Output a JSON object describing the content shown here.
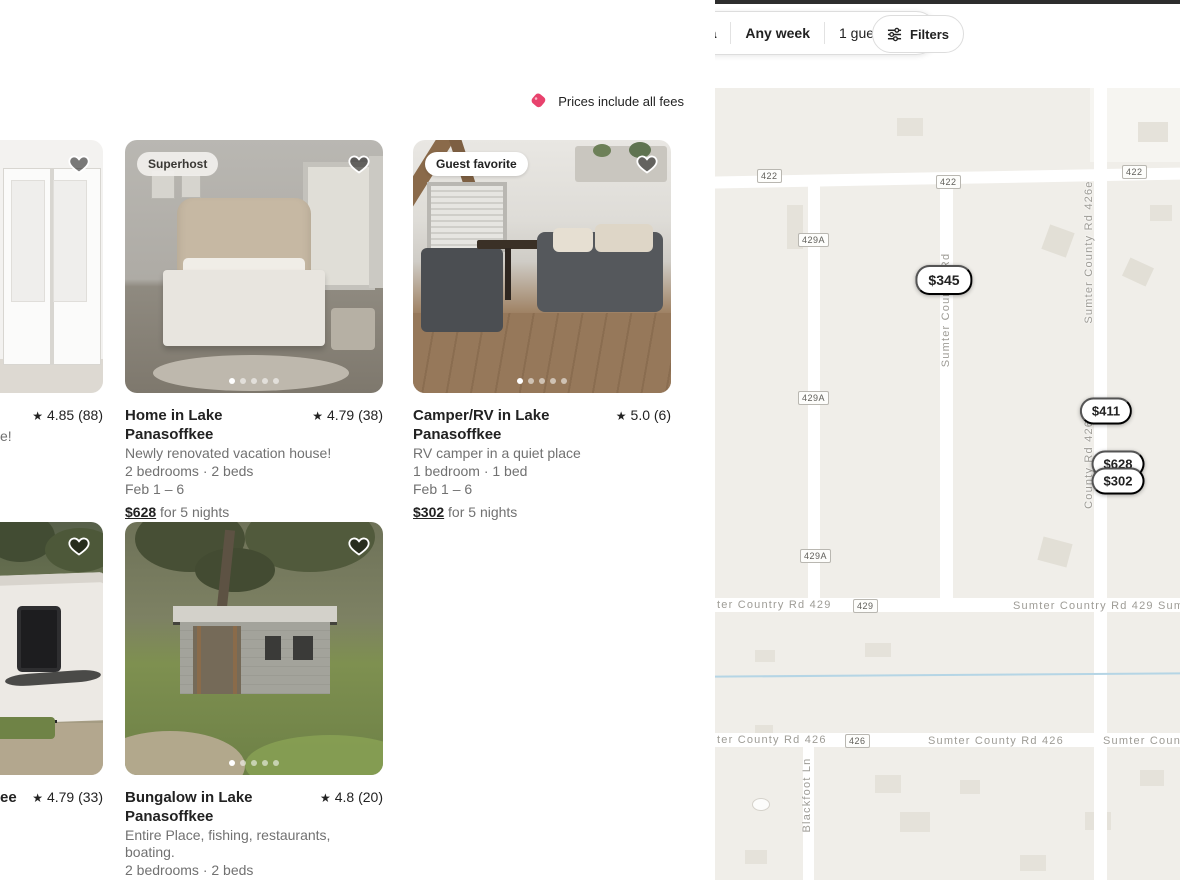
{
  "colors": {
    "accent": "#e22d5a",
    "banner_tag": "#e8426d"
  },
  "icons": {
    "star": "★"
  },
  "top_bar": {
    "search": {
      "category": "Homes in map area",
      "dates": "Any week",
      "guests": "1 guest"
    },
    "filters_label": "Filters"
  },
  "banner": {
    "text": "Prices include all fees"
  },
  "listings": [
    {
      "rating_text": "4.85 (88)",
      "subtitle_fragment": "e!"
    },
    {
      "badge": "Superhost",
      "title": "Home in Lake Panasoffkee",
      "rating_text": "4.79 (38)",
      "subtitle": "Newly renovated vacation house!",
      "capacity": "2 bedrooms · 2 beds",
      "dates": "Feb 1 – 6",
      "price": "$628",
      "price_suffix": "for 5 nights"
    },
    {
      "badge": "Guest favorite",
      "title": "Camper/RV in Lake Panasoffkee",
      "rating_text": "5.0 (6)",
      "subtitle": "RV camper in a quiet place",
      "capacity": "1 bedroom · 1 bed",
      "dates": "Feb 1 – 6",
      "price": "$302",
      "price_suffix": "for 5 nights"
    },
    {
      "title_fragment": "ee",
      "rating_text": "4.79 (33)"
    },
    {
      "title": "Bungalow in Lake Panasoffkee",
      "rating_text": "4.8 (20)",
      "subtitle": "Entire Place, fishing, restaurants, boating.",
      "capacity": "2 bedrooms · 2 beds",
      "dates": "Feb 1 – 6",
      "price": "$828",
      "price_suffix": "for 5 nights"
    }
  ],
  "map": {
    "pins": [
      {
        "price": "$345"
      },
      {
        "price": "$411"
      },
      {
        "price": "$628"
      },
      {
        "price": "$302"
      }
    ],
    "shields": [
      {
        "label": "422"
      },
      {
        "label": "429A"
      },
      {
        "label": "422"
      },
      {
        "label": "429A"
      },
      {
        "label": "429A"
      },
      {
        "label": "429"
      },
      {
        "label": "426"
      },
      {
        "label": "422"
      }
    ],
    "labels": {
      "country_rd_vertical": "Sumter Country Rd",
      "county_rd_426e_vertical": "Sumter County Rd 426e",
      "county_rd_426E_vertical": "County Rd 426 E",
      "blackfoot_ln": "Blackfoot Ln",
      "rd429_left": "ter Country Rd 429",
      "rd429_right": "Sumter Country Rd 429 Sum",
      "rd426_left": "ter County Rd 426",
      "rd426_mid": "Sumter County Rd 426",
      "rd426_right": "Sumter Coun"
    }
  }
}
